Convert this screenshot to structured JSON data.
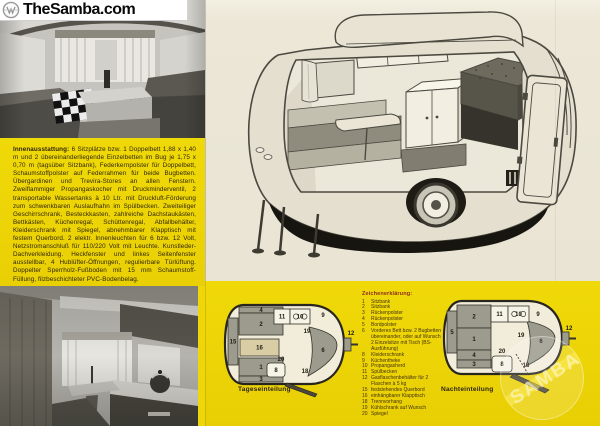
{
  "site": {
    "banner": "TheSamba.com"
  },
  "colors": {
    "panel_yellow": "#eed60a",
    "page_beige": "#e9e4d4",
    "legend_heading_red": "#8f2c1a",
    "text_brown": "#2f2507",
    "plan_gray": "#9c9b8e",
    "plan_floor": "#f2eddb"
  },
  "description_box": {
    "heading": "Innenausstattung:",
    "body": "6 Sitzplätze bzw. 1 Doppelbett 1,88 x 1,40 m und 2 übereinanderliegende Einzelbetten im Bug je 1,75 x 0,70 m (tagsüber Sitzbank), Federkernpolster für Doppelbett, Schaumstoffpolster auf Federrahmen für beide Bugbetten. Übergardinen und Trevira-Stores an allen Fenstern. Zweiflammiger Propangaskocher mit Druckminderventil, 2 transportable Wassertanks à 10 Ltr. mit Druckluft-Förderung zum schwenkbaren Auslaufhahn im Spülbecken. Zweiteiliger Geschirrschrank, Besteckkasten, zahlreiche Dachstaukästen, Bettkästen, Küchenregal, Schüttenregal, Abfallbehälter, Kleiderschrank mit Spiegel, abnehmbarer Klapptisch mit festem Querbord. 2 elektr. Innenleuchten für 6 bzw. 12 Volt, Netzstromanschluß für 110/220 Volt mit Leuchte. Kunstleder-Dachverkleidung. Heckfenster und linkes Seitenfenster ausstellbar, 4 Hublüfter-Öffnungen, regulierbare Türlüftung. Doppelter Sperrholz-Fußboden mit 15 mm Schaumstoff-Füllung, filzbeschichteter PVC-Bodenbelag."
  },
  "legend": {
    "heading": "Zeichenerklärung:",
    "items": [
      {
        "num": "1",
        "label": "Sitzbank"
      },
      {
        "num": "2",
        "label": "Sitzbank"
      },
      {
        "num": "3",
        "label": "Rückenpolster"
      },
      {
        "num": "4",
        "label": "Rückenpolster"
      },
      {
        "num": "5",
        "label": "Bordpolster"
      },
      {
        "num": "6",
        "label": "Vorderes Bett bzw. 2 Bugbetten übereinander, oder auf Wunsch 2 Einzelsitze mit Tisch (BS-Ausführung)"
      },
      {
        "num": "8",
        "label": "Kleiderschrank"
      },
      {
        "num": "9",
        "label": "Küchentheke"
      },
      {
        "num": "10",
        "label": "Propangasherd"
      },
      {
        "num": "11",
        "label": "Spülbecken"
      },
      {
        "num": "12",
        "label": "Gasflaschenbehälter für 2 Flaschen à 5 kg"
      },
      {
        "num": "15",
        "label": "feststehendes Querbord"
      },
      {
        "num": "16",
        "label": "einhängbarer Klapptisch"
      },
      {
        "num": "18",
        "label": "Trennvorhang"
      },
      {
        "num": "19",
        "label": "Kühlschrank auf Wunsch"
      },
      {
        "num": "20",
        "label": "Spiegel"
      }
    ]
  },
  "floorplans": {
    "day": {
      "caption": "Tageseinteilung",
      "outline_d": "M 26,5 L 94,5 C 116,6 127,22 127,44 C 127,66 116,83 94,84 L 26,84 C 13,83 8,68 8,44 C 8,20 13,6 26,5 Z",
      "shapes": [
        {
          "t": "path",
          "d": "M 92,27 Q 120,33 120,45 Q 120,60 91,76 Q 99,51 92,27 Z",
          "f": "gray",
          "n": "6",
          "lx": 106,
          "ly": 52
        },
        {
          "t": "rect",
          "n": "15",
          "x": 11,
          "y": 18,
          "w": 10,
          "h": 47,
          "f": "gray"
        },
        {
          "t": "rect",
          "n": "4",
          "x": 22,
          "y": 7,
          "w": 44,
          "h": 6,
          "f": "gray"
        },
        {
          "t": "rect",
          "n": "2",
          "x": 22,
          "y": 13,
          "w": 44,
          "h": 22,
          "f": "gray"
        },
        {
          "t": "rect",
          "n": "16",
          "x": 23,
          "y": 39,
          "w": 39,
          "h": 17,
          "f": "tan"
        },
        {
          "t": "rect",
          "n": "1",
          "x": 22,
          "y": 58,
          "w": 44,
          "h": 18,
          "f": "gray"
        },
        {
          "t": "rect",
          "n": "3",
          "x": 22,
          "y": 76,
          "w": 44,
          "h": 6,
          "f": "gray"
        },
        {
          "t": "rect",
          "n": "11",
          "x": 57,
          "y": 9,
          "w": 16,
          "h": 15,
          "f": "white"
        },
        {
          "t": "rect",
          "n": "10",
          "x": 73,
          "y": 9,
          "w": 20,
          "h": 15,
          "f": "white",
          "burners": true
        },
        {
          "t": "rect",
          "n": "8",
          "x": 50,
          "y": 63,
          "w": 18,
          "h": 14,
          "f": "white",
          "rx": 3
        },
        {
          "t": "hitch",
          "x": 127,
          "y": 38
        },
        {
          "t": "flap",
          "d": "M 70,83 L 100,94 L 98,97 L 68,86 Z"
        },
        {
          "t": "label",
          "n": "9",
          "x": 106,
          "y": 17
        },
        {
          "t": "label",
          "n": "19",
          "x": 90,
          "y": 33
        },
        {
          "t": "label",
          "n": "12",
          "x": 134,
          "y": 35
        },
        {
          "t": "label",
          "n": "20",
          "x": 64,
          "y": 61
        },
        {
          "t": "label",
          "n": "18",
          "x": 88,
          "y": 73
        }
      ]
    },
    "night": {
      "caption": "Nachteinteilung",
      "outline_d": "M 24,5 L 92,5 C 114,6 125,21 125,42 C 125,62 114,77 92,78 L 24,78 C 12,77 7,63 7,42 C 7,19 12,6 24,5 Z",
      "shapes": [
        {
          "t": "path",
          "d": "M 90,25 Q 118,31 118,42 Q 118,56 89,70 Q 97,47 90,25 Z",
          "f": "gray",
          "n": "6",
          "lx": 104,
          "ly": 47
        },
        {
          "t": "rect",
          "n": "5",
          "x": 10,
          "y": 15,
          "w": 10,
          "h": 42,
          "f": "gray"
        },
        {
          "t": "rect",
          "n": "2",
          "x": 20,
          "y": 9,
          "w": 34,
          "h": 23,
          "f": "gray"
        },
        {
          "t": "rect",
          "n": "1",
          "x": 20,
          "y": 32,
          "w": 34,
          "h": 22,
          "f": "gray"
        },
        {
          "t": "rect",
          "n": "4",
          "x": 20,
          "y": 54,
          "w": 34,
          "h": 10,
          "f": "gray"
        },
        {
          "t": "rect",
          "n": "3",
          "x": 20,
          "y": 64,
          "w": 34,
          "h": 8,
          "f": "gray"
        },
        {
          "t": "rect",
          "n": "11",
          "x": 54,
          "y": 10,
          "w": 17,
          "h": 16,
          "f": "white"
        },
        {
          "t": "rect",
          "n": "10",
          "x": 71,
          "y": 10,
          "w": 21,
          "h": 16,
          "f": "white",
          "burners": true
        },
        {
          "t": "rect",
          "n": "8",
          "x": 55,
          "y": 60,
          "w": 20,
          "h": 16,
          "f": "white",
          "rx": 3
        },
        {
          "t": "hitch",
          "x": 125,
          "y": 36
        },
        {
          "t": "dash",
          "x1": 79,
          "y1": 58,
          "x2": 91,
          "y2": 78
        },
        {
          "t": "flap",
          "d": "M 77,78 L 112,94 L 108,97 L 73,81 Z"
        },
        {
          "t": "label",
          "n": "9",
          "x": 101,
          "y": 20
        },
        {
          "t": "label",
          "n": "19",
          "x": 84,
          "y": 41
        },
        {
          "t": "label",
          "n": "12",
          "x": 132,
          "y": 34
        },
        {
          "t": "label",
          "n": "20",
          "x": 65,
          "y": 57
        },
        {
          "t": "label",
          "n": "18",
          "x": 89,
          "y": 71
        }
      ]
    }
  },
  "watermark": {
    "text": "SAMBA"
  }
}
